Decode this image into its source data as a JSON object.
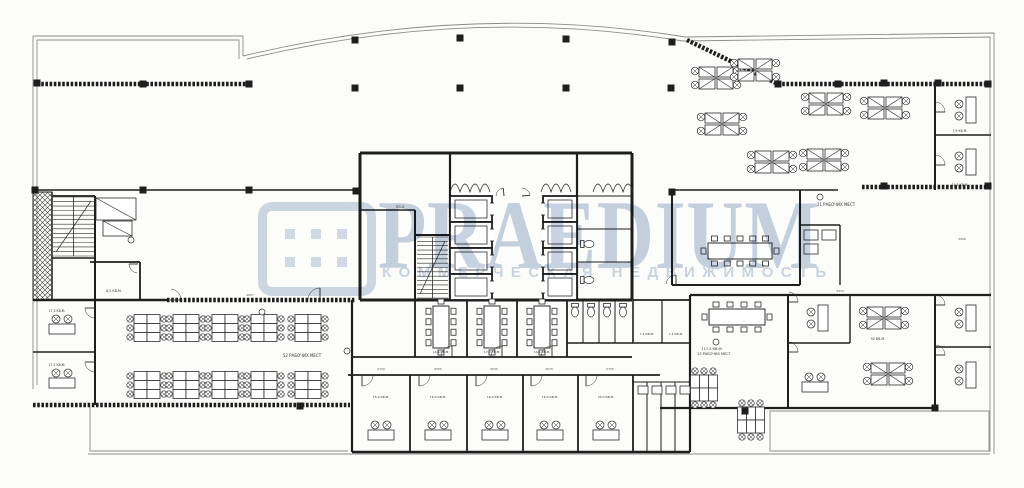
{
  "watermark": {
    "brand": "PRAEDIUM",
    "tagline": "КОММЕРЧЕСКАЯ НЕДВИЖИМОСТЬ",
    "logo_color": "#cfd9e6",
    "text_color": "#c7d2e2"
  },
  "plan": {
    "colors": {
      "wall": "#1e1e1e",
      "thin": "#8b8b8b",
      "furn": "#2b2b2b",
      "paper": "#fcfcfa",
      "label": "#333333",
      "dim": "#555555"
    },
    "thin_paths": [
      "M33,36 H243 V56",
      "M243,56 Q468,2 686,37 L994,33 V454",
      "M33,36 V389",
      "M37,40 H239 V59",
      "M247,59 Q468,6 683,41 L990,37 V84",
      "M37,40 V385",
      "M90,407 V451 H348",
      "M88,454 H990",
      "M770,411 H989 V451 H770 Z",
      "M990,84 V452"
    ],
    "hatch_walls": [
      [
        37,
        84,
        247,
        84
      ],
      [
        687,
        40,
        778,
        84
      ],
      [
        778,
        84,
        990,
        84
      ],
      [
        862,
        187,
        990,
        187
      ],
      [
        167,
        300,
        355,
        300
      ],
      [
        33,
        405,
        350,
        405
      ]
    ],
    "walls": [
      [
        33,
        190,
        360,
        190,
        1.6
      ],
      [
        360,
        153,
        632,
        153,
        3
      ],
      [
        360,
        153,
        360,
        300,
        3
      ],
      [
        632,
        153,
        632,
        300,
        3
      ],
      [
        360,
        300,
        632,
        300,
        3
      ],
      [
        450,
        153,
        450,
        300,
        2.2
      ],
      [
        415,
        210,
        415,
        300,
        2
      ],
      [
        360,
        210,
        415,
        210,
        1.6
      ],
      [
        415,
        235,
        450,
        235,
        2
      ],
      [
        577,
        153,
        577,
        300,
        2.2
      ],
      [
        577,
        196,
        632,
        196,
        1
      ],
      [
        577,
        229,
        632,
        229,
        1
      ],
      [
        577,
        262,
        632,
        262,
        1
      ],
      [
        352,
        300,
        352,
        452,
        2.2
      ],
      [
        415,
        300,
        415,
        357,
        1.8
      ],
      [
        467,
        300,
        467,
        357,
        1.8
      ],
      [
        517,
        300,
        517,
        357,
        1.8
      ],
      [
        567,
        300,
        567,
        357,
        1.8
      ],
      [
        352,
        357,
        632,
        357,
        1.8
      ],
      [
        583,
        300,
        583,
        343,
        1
      ],
      [
        599,
        300,
        599,
        343,
        1
      ],
      [
        615,
        300,
        615,
        343,
        1
      ],
      [
        633,
        300,
        633,
        343,
        1.6
      ],
      [
        662,
        300,
        662,
        343,
        1.2
      ],
      [
        567,
        343,
        690,
        343,
        1.4
      ],
      [
        348,
        375,
        660,
        375,
        1.8
      ],
      [
        410,
        375,
        410,
        452,
        1.8
      ],
      [
        467,
        375,
        467,
        452,
        1.8
      ],
      [
        523,
        375,
        523,
        452,
        1.8
      ],
      [
        578,
        375,
        578,
        452,
        1.8
      ],
      [
        633,
        375,
        633,
        452,
        1.8
      ],
      [
        352,
        452,
        690,
        452,
        2.4
      ],
      [
        647,
        382,
        647,
        452,
        1
      ],
      [
        661,
        382,
        661,
        452,
        1
      ],
      [
        675,
        382,
        675,
        452,
        1
      ],
      [
        633,
        382,
        690,
        382,
        1
      ],
      [
        690,
        295,
        690,
        452,
        2.2
      ],
      [
        633,
        300,
        690,
        300,
        1.8
      ],
      [
        690,
        295,
        991,
        295,
        2.2
      ],
      [
        788,
        295,
        788,
        407,
        2
      ],
      [
        788,
        343,
        850,
        343,
        1.6
      ],
      [
        850,
        295,
        850,
        343,
        1.4
      ],
      [
        935,
        295,
        935,
        407,
        2
      ],
      [
        935,
        347,
        991,
        347,
        1.6
      ],
      [
        660,
        408,
        935,
        408,
        2.2
      ],
      [
        672,
        190,
        672,
        285,
        2
      ],
      [
        672,
        285,
        800,
        285,
        2
      ],
      [
        800,
        190,
        800,
        285,
        2
      ],
      [
        672,
        190,
        838,
        190,
        1.6
      ],
      [
        800,
        225,
        840,
        225,
        1.4
      ],
      [
        840,
        225,
        840,
        285,
        1.4
      ],
      [
        935,
        85,
        935,
        190,
        2
      ],
      [
        935,
        135,
        991,
        135,
        1.6
      ],
      [
        52,
        192,
        52,
        300,
        1.5
      ],
      [
        95,
        196,
        95,
        300,
        2
      ],
      [
        52,
        196,
        95,
        196,
        1.8
      ],
      [
        52,
        258,
        95,
        258,
        1.5
      ],
      [
        90,
        262,
        140,
        262,
        1.8
      ],
      [
        140,
        262,
        140,
        300,
        1.8
      ],
      [
        33,
        300,
        167,
        300,
        2.4
      ],
      [
        33,
        352,
        95,
        352,
        1.6
      ],
      [
        95,
        300,
        95,
        405,
        2
      ]
    ],
    "crosshatch": [
      [
        33,
        192,
        19,
        108
      ]
    ],
    "stairs": [
      {
        "x": 417,
        "y": 237,
        "w": 31,
        "h": 61,
        "steps": 14
      },
      {
        "x": 53,
        "y": 197,
        "w": 41,
        "h": 59,
        "steps": 13
      }
    ],
    "elevators": [
      {
        "x": 450,
        "y": 196,
        "w": 42,
        "h": 26,
        "d": "r"
      },
      {
        "x": 450,
        "y": 222,
        "w": 42,
        "h": 26,
        "d": "r"
      },
      {
        "x": 450,
        "y": 248,
        "w": 42,
        "h": 26,
        "d": "r"
      },
      {
        "x": 450,
        "y": 274,
        "w": 42,
        "h": 26,
        "d": "r"
      },
      {
        "x": 543,
        "y": 196,
        "w": 34,
        "h": 26,
        "d": "l"
      },
      {
        "x": 543,
        "y": 222,
        "w": 34,
        "h": 26,
        "d": "l"
      },
      {
        "x": 543,
        "y": 248,
        "w": 34,
        "h": 26,
        "d": "l"
      },
      {
        "x": 543,
        "y": 274,
        "w": 34,
        "h": 26,
        "d": "l"
      }
    ],
    "zigzags": [
      [
        450,
        192,
        4
      ],
      [
        541,
        192,
        3
      ],
      [
        593,
        192,
        4
      ]
    ],
    "furniture": [
      {
        "t": "quad",
        "x": 716,
        "y": 78
      },
      {
        "t": "quad",
        "x": 755,
        "y": 70
      },
      {
        "t": "quad",
        "x": 722,
        "y": 124
      },
      {
        "t": "quad",
        "x": 826,
        "y": 104
      },
      {
        "t": "quad",
        "x": 885,
        "y": 108
      },
      {
        "t": "quad",
        "x": 824,
        "y": 160
      },
      {
        "t": "quad",
        "x": 772,
        "y": 162
      },
      {
        "t": "quad",
        "x": 884,
        "y": 318
      },
      {
        "t": "quad",
        "x": 888,
        "y": 374
      },
      {
        "t": "bench6",
        "x": 147,
        "y": 328
      },
      {
        "t": "bench6",
        "x": 186,
        "y": 328
      },
      {
        "t": "bench6",
        "x": 225,
        "y": 328
      },
      {
        "t": "bench6",
        "x": 264,
        "y": 328
      },
      {
        "t": "bench6",
        "x": 308,
        "y": 328
      },
      {
        "t": "bench6",
        "x": 147,
        "y": 385
      },
      {
        "t": "bench6",
        "x": 186,
        "y": 385
      },
      {
        "t": "bench6",
        "x": 225,
        "y": 385
      },
      {
        "t": "bench6",
        "x": 264,
        "y": 385
      },
      {
        "t": "bench6",
        "x": 308,
        "y": 385
      },
      {
        "t": "bench6",
        "x": 704,
        "y": 388,
        "r": 90
      },
      {
        "t": "bench6",
        "x": 751,
        "y": 420,
        "r": 90
      },
      {
        "t": "desk1",
        "x": 62,
        "y": 322
      },
      {
        "t": "desk1",
        "x": 62,
        "y": 376
      },
      {
        "t": "desk1",
        "x": 381,
        "y": 428
      },
      {
        "t": "desk1",
        "x": 438,
        "y": 428
      },
      {
        "t": "desk1",
        "x": 495,
        "y": 428
      },
      {
        "t": "desk1",
        "x": 550,
        "y": 428
      },
      {
        "t": "desk1",
        "x": 606,
        "y": 428
      },
      {
        "t": "desk1v",
        "x": 963,
        "y": 110
      },
      {
        "t": "desk1v",
        "x": 963,
        "y": 162
      },
      {
        "t": "desk1v",
        "x": 963,
        "y": 318
      },
      {
        "t": "desk1v",
        "x": 963,
        "y": 375
      },
      {
        "t": "desk1v",
        "x": 815,
        "y": 318
      },
      {
        "t": "desk1",
        "x": 815,
        "y": 380
      },
      {
        "t": "meet",
        "x": 740,
        "y": 251,
        "len": 64,
        "n": 5
      },
      {
        "t": "meet",
        "x": 737,
        "y": 317,
        "len": 56,
        "n": 4
      },
      {
        "t": "meetv",
        "x": 441,
        "y": 327,
        "len": 42,
        "n": 4
      },
      {
        "t": "meetv",
        "x": 492,
        "y": 327,
        "len": 42,
        "n": 4
      },
      {
        "t": "meetv",
        "x": 542,
        "y": 327,
        "len": 42,
        "n": 4
      },
      {
        "t": "toilet",
        "x": 589,
        "y": 244,
        "r": 270
      },
      {
        "t": "toilet",
        "x": 589,
        "y": 280,
        "r": 270
      },
      {
        "t": "toilet",
        "x": 575,
        "y": 312
      },
      {
        "t": "toilet",
        "x": 591,
        "y": 312
      },
      {
        "t": "toilet",
        "x": 607,
        "y": 312
      },
      {
        "t": "toilet",
        "x": 623,
        "y": 312
      },
      {
        "t": "box",
        "x": 804,
        "y": 230,
        "w": 14,
        "h": 10
      },
      {
        "t": "box",
        "x": 804,
        "y": 244,
        "w": 14,
        "h": 10
      },
      {
        "t": "box",
        "x": 822,
        "y": 230,
        "w": 14,
        "h": 10
      },
      {
        "t": "box",
        "x": 638,
        "y": 386,
        "w": 10,
        "h": 8
      },
      {
        "t": "box",
        "x": 652,
        "y": 386,
        "w": 10,
        "h": 8
      },
      {
        "t": "box",
        "x": 666,
        "y": 386,
        "w": 10,
        "h": 8
      },
      {
        "t": "box",
        "x": 680,
        "y": 386,
        "w": 10,
        "h": 8
      },
      {
        "t": "trap",
        "x": 96,
        "y": 198,
        "w": 40,
        "h": 22
      },
      {
        "t": "trap",
        "x": 103,
        "y": 221,
        "w": 29,
        "h": 15
      }
    ],
    "doors": [
      [
        362,
        375,
        11,
        5
      ],
      [
        419,
        375,
        11,
        5
      ],
      [
        476,
        375,
        11,
        5
      ],
      [
        531,
        375,
        11,
        5
      ],
      [
        586,
        375,
        11,
        5
      ],
      [
        452,
        357,
        11,
        185
      ],
      [
        502,
        357,
        11,
        185
      ],
      [
        552,
        357,
        11,
        185
      ],
      [
        95,
        308,
        10,
        95
      ],
      [
        95,
        362,
        10,
        95
      ],
      [
        138,
        264,
        9,
        95
      ],
      [
        676,
        285,
        10,
        185
      ],
      [
        788,
        302,
        10,
        275
      ],
      [
        788,
        352,
        10,
        275
      ],
      [
        935,
        305,
        10,
        275
      ],
      [
        935,
        355,
        10,
        275
      ],
      [
        935,
        112,
        10,
        275
      ],
      [
        935,
        165,
        10,
        275
      ],
      [
        504,
        196,
        8,
        180
      ],
      [
        522,
        196,
        8,
        270
      ],
      [
        320,
        300,
        12,
        185
      ],
      [
        170,
        300,
        11,
        275
      ]
    ],
    "columns": [
      [
        37,
        83
      ],
      [
        143,
        84
      ],
      [
        249,
        84
      ],
      [
        355,
        40
      ],
      [
        460,
        38
      ],
      [
        566,
        39
      ],
      [
        672,
        42
      ],
      [
        355,
        88
      ],
      [
        460,
        88
      ],
      [
        566,
        88
      ],
      [
        671,
        88
      ],
      [
        35,
        190
      ],
      [
        143,
        190
      ],
      [
        249,
        190
      ],
      [
        356,
        191
      ],
      [
        672,
        192
      ],
      [
        778,
        84
      ],
      [
        838,
        84
      ],
      [
        884,
        83
      ],
      [
        938,
        83
      ],
      [
        988,
        84
      ],
      [
        884,
        186
      ],
      [
        988,
        186
      ],
      [
        300,
        406
      ],
      [
        745,
        411
      ],
      [
        935,
        408
      ]
    ],
    "labels": [
      {
        "t": "52 РАБОЧИХ МЕСТ",
        "x": 302,
        "y": 357,
        "fs": 4
      },
      {
        "t": "21 РАБОЧИХ МЕСТ",
        "x": 836,
        "y": 206,
        "fs": 4
      },
      {
        "t": "117,4 КВ.М.",
        "x": 712,
        "y": 350,
        "fs": 3.5
      },
      {
        "t": "23 РАБОЧИХ МЕСТ",
        "x": 714,
        "y": 355,
        "fs": 3.5
      },
      {
        "t": "6,5 КВ.М.",
        "x": 114,
        "y": 292,
        "fs": 3.3
      },
      {
        "t": "17,3 КВ.М.",
        "x": 57,
        "y": 312,
        "fs": 3.1
      },
      {
        "t": "17,2 КВ.М.",
        "x": 57,
        "y": 366,
        "fs": 3.1
      },
      {
        "t": "7,1 КВ.М.",
        "x": 647,
        "y": 335,
        "fs": 3
      },
      {
        "t": "7,1 КВ.М.",
        "x": 676,
        "y": 335,
        "fs": 3
      },
      {
        "t": "11,3 КВ.М.",
        "x": 960,
        "y": 186,
        "fs": 3.1
      },
      {
        "t": "7,9 КВ.М.",
        "x": 960,
        "y": 132,
        "fs": 3.1
      },
      {
        "t": "ПС-5",
        "x": 400,
        "y": 208,
        "fs": 3.5
      },
      {
        "t": "14,9 КВ.М.",
        "x": 441,
        "y": 353,
        "fs": 3
      },
      {
        "t": "17,0 КВ.М.",
        "x": 492,
        "y": 353,
        "fs": 3
      },
      {
        "t": "14,9 КВ.М.",
        "x": 542,
        "y": 353,
        "fs": 3
      },
      {
        "t": "15,2 КВ.М.",
        "x": 381,
        "y": 398,
        "fs": 3
      },
      {
        "t": "16,0 КВ.М.",
        "x": 438,
        "y": 398,
        "fs": 3
      },
      {
        "t": "16,0 КВ.М.",
        "x": 495,
        "y": 398,
        "fs": 3
      },
      {
        "t": "16,0 КВ.М.",
        "x": 550,
        "y": 398,
        "fs": 3
      },
      {
        "t": "24,0 КВ.М.",
        "x": 606,
        "y": 398,
        "fs": 3
      },
      {
        "t": "92 КВ.М.",
        "x": 878,
        "y": 340,
        "fs": 3.3
      }
    ],
    "dims": [
      {
        "t": "4150",
        "x": 381,
        "y": 370
      },
      {
        "t": "6055",
        "x": 438,
        "y": 370
      },
      {
        "t": "4035",
        "x": 494,
        "y": 370
      },
      {
        "t": "4070",
        "x": 549,
        "y": 370
      },
      {
        "t": "5756",
        "x": 610,
        "y": 370
      },
      {
        "t": "4657",
        "x": 250,
        "y": 296
      },
      {
        "t": "3434",
        "x": 840,
        "y": 292
      },
      {
        "t": "3006",
        "x": 962,
        "y": 240
      }
    ],
    "marks": [
      [
        347,
        351
      ],
      [
        820,
        197
      ],
      [
        262,
        312
      ],
      [
        131,
        240
      ],
      [
        716,
        342
      ]
    ]
  }
}
